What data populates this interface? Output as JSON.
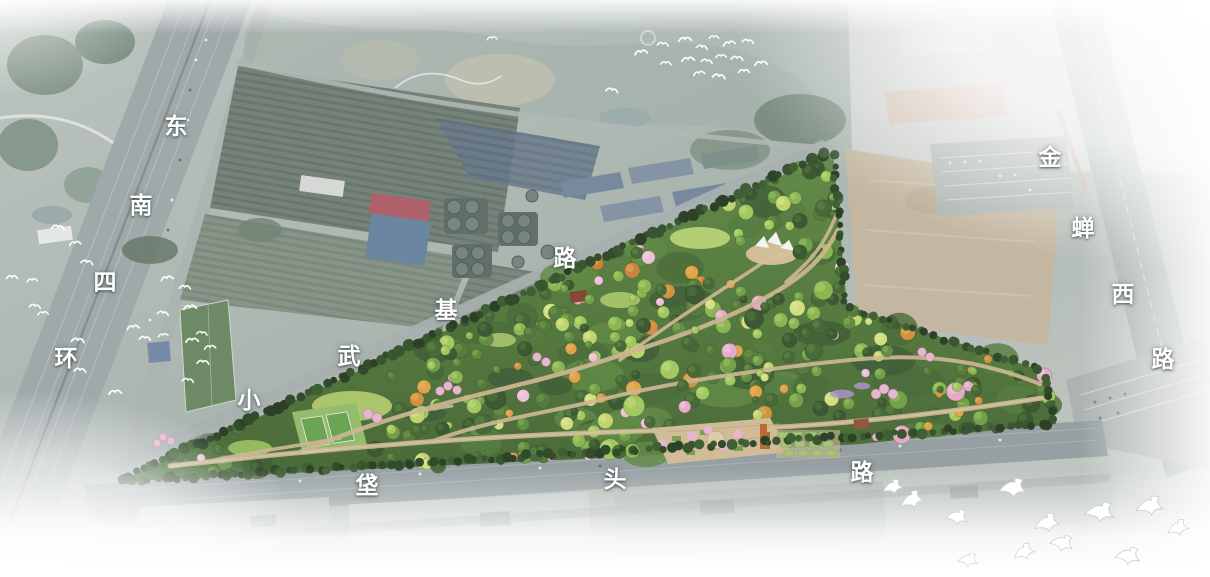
{
  "scene": {
    "type": "aerial-masterplan-rendering",
    "subject": "triangular urban forest park rendered in green over a desaturated satellite photo",
    "effects": [
      "white haze vignette on all edges",
      "white bird flocks"
    ]
  },
  "colors": {
    "label_text": "#ffffff",
    "park_dark_green": "#2f4c24",
    "park_light_green": "#83b147",
    "blossom_pink": "#e2a4c4",
    "autumn_orange": "#cf8a33",
    "path_tan": "#c9b28c",
    "plaza_tan": "#cdb790",
    "tower_orange": "#b95f2a",
    "red_roof": "#a85560",
    "blue_roof": "#5f7d99",
    "road_gray": "#99a3a4",
    "dirt_tan": "#c0b29a",
    "photo_green": "#8a9a8e",
    "haze_white": "#ffffff"
  },
  "roads": [
    {
      "id": "southeast-fourth-ring",
      "name": "东南四环",
      "chars": [
        {
          "ch": "东",
          "x": 176,
          "y": 124
        },
        {
          "ch": "南",
          "x": 141,
          "y": 203
        },
        {
          "ch": "四",
          "x": 105,
          "y": 280
        },
        {
          "ch": "环",
          "x": 66,
          "y": 356
        }
      ]
    },
    {
      "id": "xiaowuji-road",
      "name": "小武基路",
      "chars": [
        {
          "ch": "小",
          "x": 249,
          "y": 398
        },
        {
          "ch": "武",
          "x": 349,
          "y": 354
        },
        {
          "ch": "基",
          "x": 446,
          "y": 308
        },
        {
          "ch": "路",
          "x": 565,
          "y": 256
        }
      ]
    },
    {
      "id": "fatou-road",
      "name": "垡头路",
      "chars": [
        {
          "ch": "垡",
          "x": 367,
          "y": 483
        },
        {
          "ch": "头",
          "x": 615,
          "y": 477
        },
        {
          "ch": "路",
          "x": 862,
          "y": 470
        }
      ]
    },
    {
      "id": "jinchan-west-road",
      "name": "金蝉西路",
      "chars": [
        {
          "ch": "金",
          "x": 1050,
          "y": 155
        },
        {
          "ch": "蝉",
          "x": 1083,
          "y": 226
        },
        {
          "ch": "西",
          "x": 1123,
          "y": 292
        },
        {
          "ch": "路",
          "x": 1163,
          "y": 357
        }
      ]
    }
  ],
  "park": {
    "seed": 42,
    "bbox": [
      118,
      152,
      1056,
      482
    ],
    "polygon": [
      [
        118,
        482
      ],
      [
        833,
        152
      ],
      [
        847,
        306
      ],
      [
        1046,
        372
      ],
      [
        1056,
        424
      ],
      [
        860,
        444
      ],
      [
        600,
        458
      ],
      [
        350,
        470
      ]
    ],
    "clearings": [
      [
        352,
        408,
        42
      ],
      [
        308,
        432,
        46
      ],
      [
        716,
        440,
        42
      ],
      [
        772,
        254,
        27
      ],
      [
        700,
        238,
        29
      ],
      [
        800,
        442,
        36
      ],
      [
        863,
        424,
        15
      ]
    ],
    "tree_greens": [
      "#2f4c24",
      "#3b5e2a",
      "#49712f",
      "#578536",
      "#699a3c",
      "#83b147",
      "#9ac455"
    ],
    "tree_highlights": [
      "#49712f",
      "#578536",
      "#699a3c",
      "#83b147",
      "#9ac455",
      "#aed25f",
      "#c2de74"
    ],
    "accents": {
      "orange": [
        "#cf8a33",
        "#dd9c3c",
        "#c47a2e"
      ],
      "orange_hi": "#e8b25c",
      "pink": [
        "#e2a4c4",
        "#eebdd6"
      ],
      "pink_hi": "#f3cfe0",
      "lime": [
        "#bcd065",
        "#cfdc78"
      ],
      "lime_hi": "#e0e98f"
    },
    "clump_colors": [
      "#33532a",
      "#3e632e",
      "#4a7434",
      "#568339"
    ],
    "conifer_colors": [
      "#1c3317",
      "#233e1c",
      "#2a4a21",
      "#315426"
    ],
    "counts": {
      "canopy_clumps": 46,
      "trees": 290,
      "overlay_trees": 62
    },
    "edge_rows": [
      {
        "from": [
          120,
          480
        ],
        "to": [
          831,
          151
        ],
        "n": 105,
        "rmin": 3.2,
        "rmax": 6.2
      },
      {
        "from": [
          122,
          481
        ],
        "to": [
          1054,
          424
        ],
        "n": 120,
        "rmin": 3.0,
        "rmax": 5.5
      },
      {
        "from": [
          833,
          154
        ],
        "to": [
          846,
          304
        ],
        "n": 20,
        "rmin": 3.0,
        "rmax": 5.0
      },
      {
        "from": [
          848,
          308
        ],
        "to": [
          1044,
          371
        ],
        "n": 26,
        "rmin": 3.0,
        "rmax": 5.0
      },
      {
        "from": [
          1046,
          374
        ],
        "to": [
          1055,
          423
        ],
        "n": 8,
        "rmin": 3.0,
        "rmax": 4.5
      }
    ]
  },
  "birds": {
    "small": [
      [
        641,
        52,
        0.9,
        -8
      ],
      [
        663,
        44,
        0.8,
        6
      ],
      [
        685,
        39,
        0.9,
        -4
      ],
      [
        702,
        47,
        0.8,
        10
      ],
      [
        714,
        37,
        0.7,
        0
      ],
      [
        729,
        43,
        0.85,
        -12
      ],
      [
        748,
        41,
        0.8,
        8
      ],
      [
        666,
        63,
        0.75,
        4
      ],
      [
        688,
        59,
        0.9,
        -6
      ],
      [
        707,
        61,
        0.8,
        12
      ],
      [
        721,
        56,
        0.75,
        -3
      ],
      [
        737,
        58,
        0.85,
        5
      ],
      [
        699,
        73,
        0.8,
        -10
      ],
      [
        719,
        76,
        0.9,
        8
      ],
      [
        744,
        71,
        0.8,
        0
      ],
      [
        761,
        63,
        0.9,
        -6
      ],
      [
        612,
        90,
        0.85,
        10
      ],
      [
        492,
        38,
        0.7,
        -5
      ],
      [
        58,
        227,
        0.9,
        5
      ],
      [
        75,
        243,
        0.8,
        -8
      ],
      [
        87,
        262,
        0.85,
        10
      ],
      [
        12,
        277,
        0.8,
        0
      ],
      [
        32,
        280,
        0.75,
        -6
      ],
      [
        35,
        306,
        0.8,
        8
      ],
      [
        43,
        313,
        0.75,
        -4
      ],
      [
        78,
        340,
        0.9,
        6
      ],
      [
        167,
        278,
        0.85,
        -10
      ],
      [
        185,
        287,
        0.8,
        4
      ],
      [
        190,
        307,
        0.9,
        -5
      ],
      [
        163,
        313,
        0.8,
        10
      ],
      [
        133,
        327,
        0.85,
        -8
      ],
      [
        145,
        338,
        0.8,
        5
      ],
      [
        192,
        340,
        0.9,
        -4
      ],
      [
        202,
        333,
        0.75,
        8
      ],
      [
        210,
        347,
        0.8,
        -6
      ],
      [
        203,
        362,
        0.85,
        4
      ],
      [
        163,
        335,
        0.7,
        -10
      ],
      [
        80,
        370,
        0.85,
        6
      ],
      [
        115,
        392,
        0.9,
        -5
      ],
      [
        188,
        380,
        0.8,
        8
      ]
    ],
    "doves": [
      [
        893,
        487,
        1.1,
        -6
      ],
      [
        912,
        500,
        1.3,
        -12
      ],
      [
        1013,
        488,
        1.5,
        6
      ],
      [
        957,
        517,
        1.2,
        14
      ],
      [
        1047,
        523,
        1.4,
        -6
      ],
      [
        1100,
        512,
        1.6,
        10
      ],
      [
        1062,
        543,
        1.3,
        18
      ],
      [
        1024,
        552,
        1.2,
        -14
      ],
      [
        1150,
        506,
        1.5,
        0
      ],
      [
        968,
        560,
        1.1,
        10
      ],
      [
        1128,
        556,
        1.4,
        12
      ],
      [
        1178,
        528,
        1.2,
        -8
      ]
    ]
  }
}
